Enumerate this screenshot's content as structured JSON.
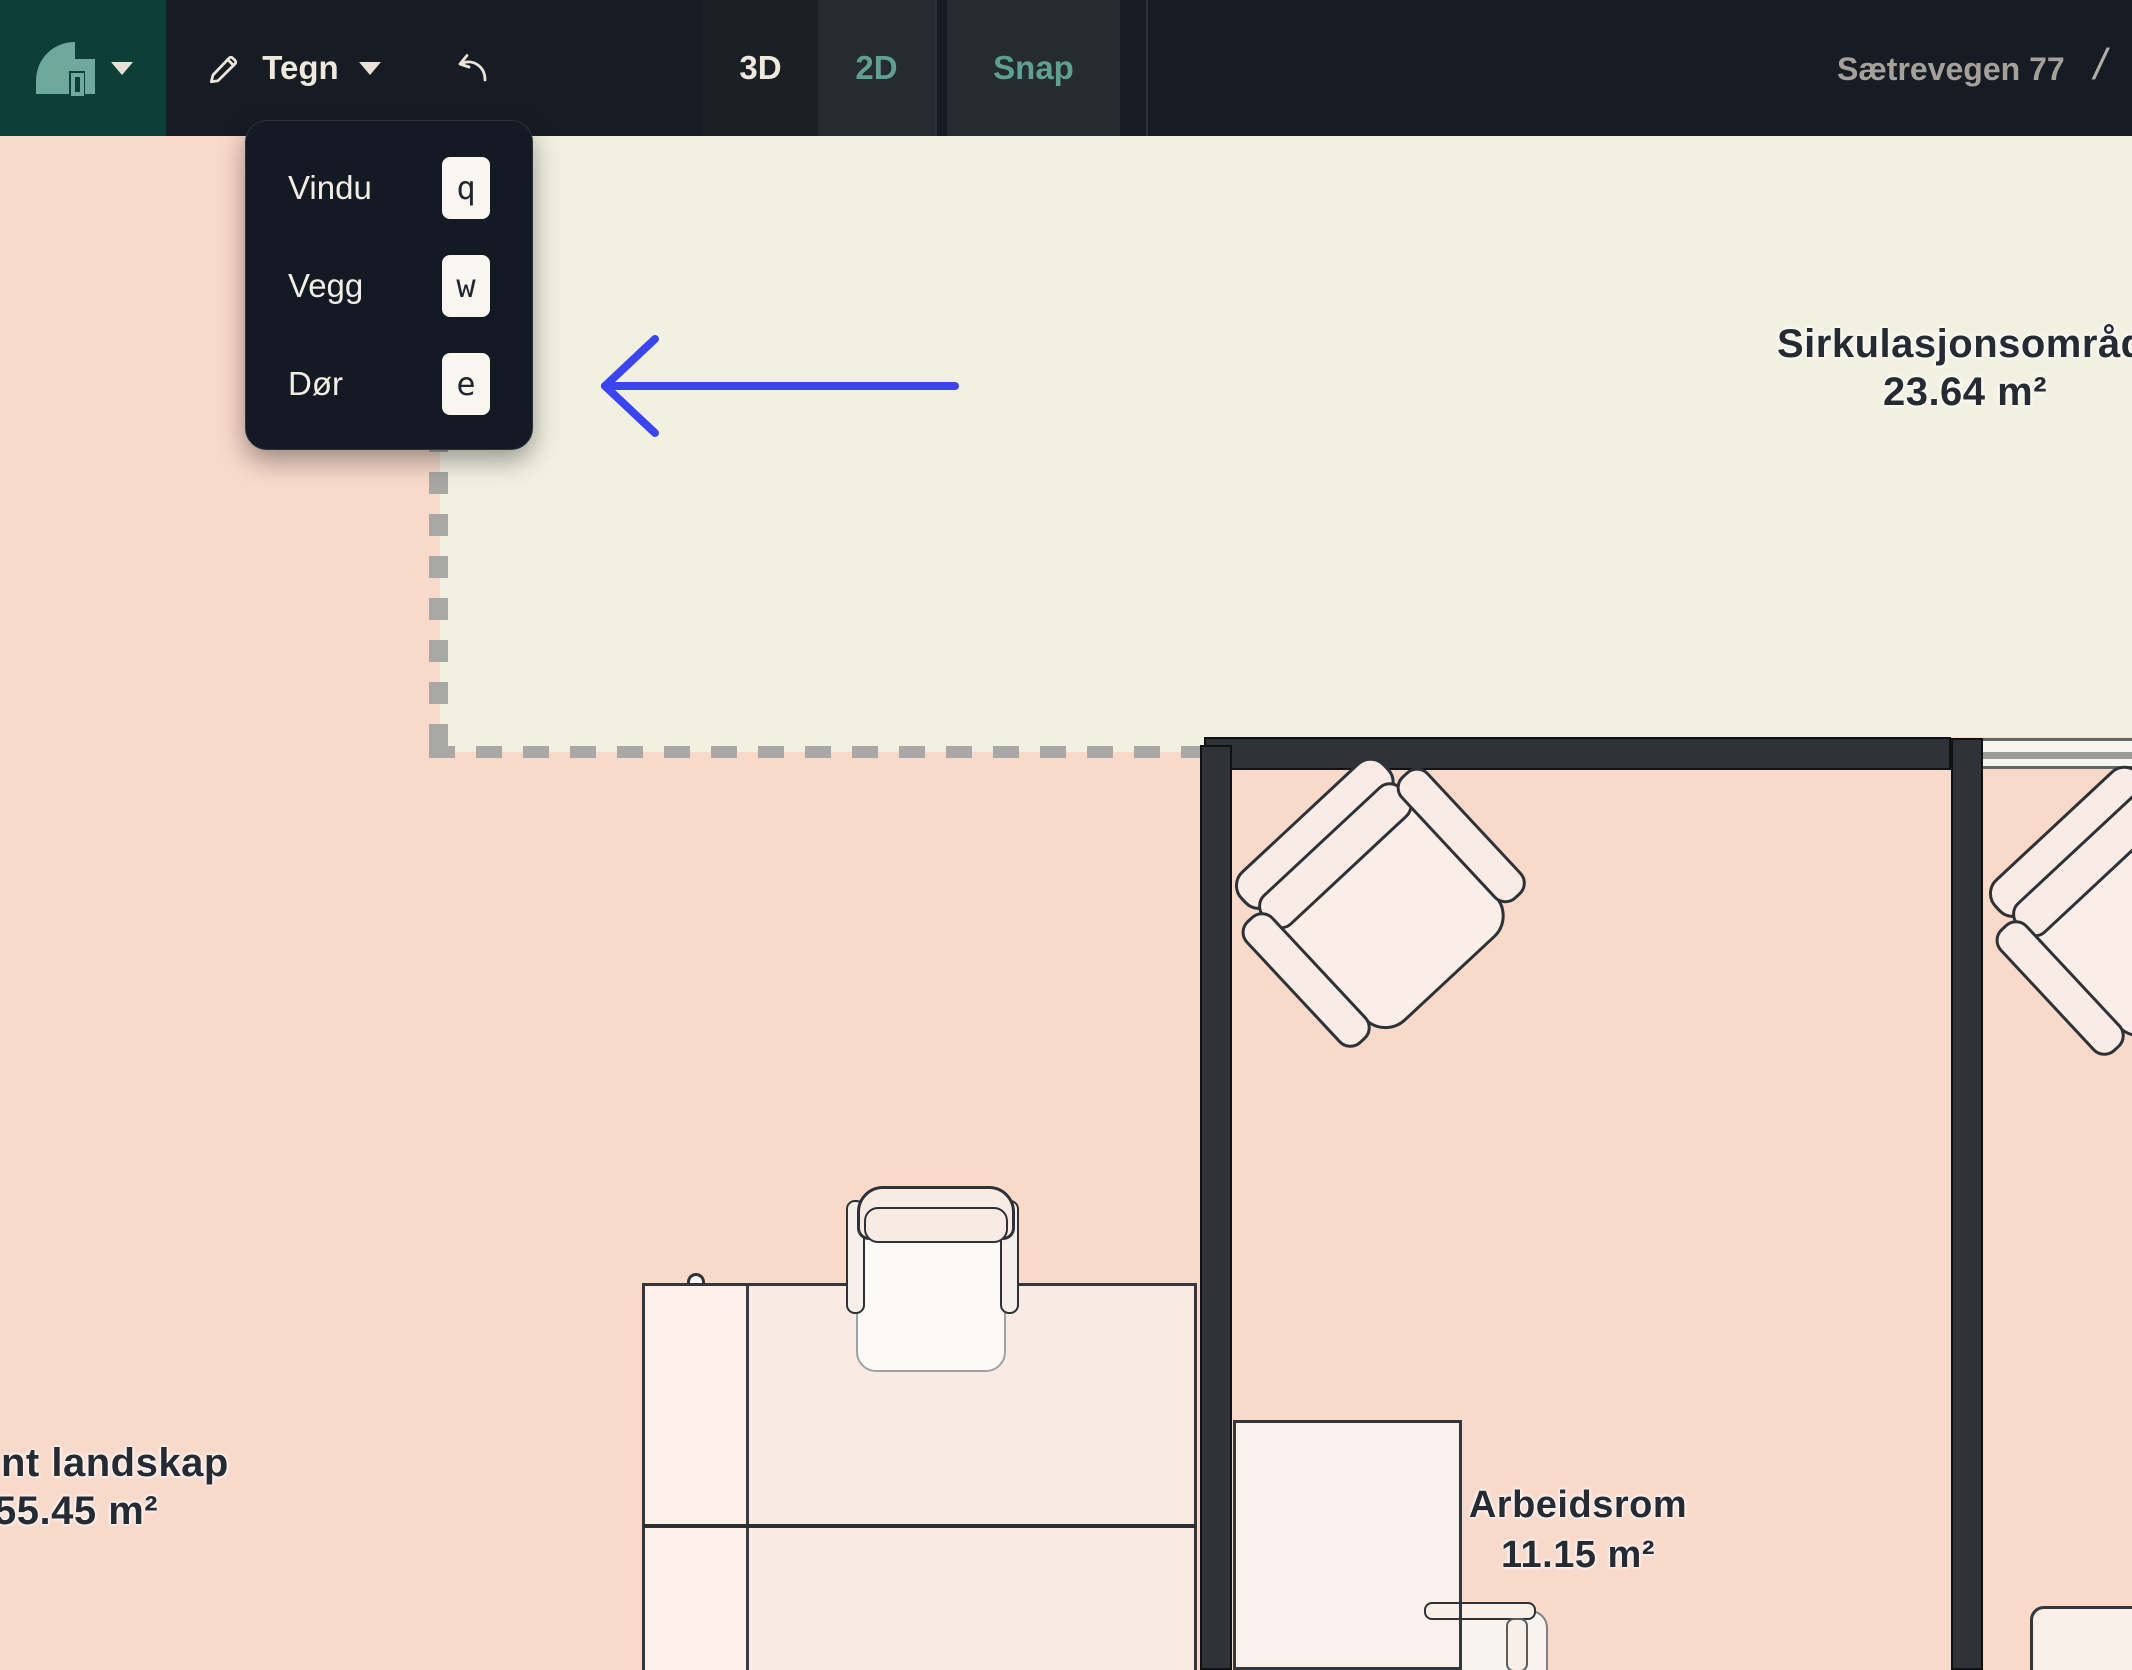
{
  "toolbar": {
    "logo_icon": "roof-logo-icon",
    "draw_tool_label": "Tegn",
    "view_3d_label": "3D",
    "view_2d_label": "2D",
    "snap_label": "Snap",
    "project_name": "Sætrevegen 77",
    "breadcrumb_separator": "/"
  },
  "draw_menu": {
    "items": [
      {
        "label": "Vindu",
        "key": "q"
      },
      {
        "label": "Vegg",
        "key": "w"
      },
      {
        "label": "Dør",
        "key": "e"
      }
    ]
  },
  "floorplan": {
    "rooms": [
      {
        "name": "Sirkulasjonsområde",
        "area": "23.64 m²"
      },
      {
        "name": "nt landskap",
        "area": "55.45 m²"
      },
      {
        "name": "Arbeidsrom",
        "area": "11.15 m²"
      }
    ],
    "furniture": [
      "armchair",
      "office-chair",
      "desk",
      "window"
    ],
    "annotation": "blue-arrow-pointing-left-at-draw-menu"
  },
  "colors": {
    "floor_pink": "#f8d9ca",
    "room_cream": "#f2f1e1",
    "wall": "#2f3337",
    "toolbar_bg": "#171c24",
    "logo_tile": "#0e3e38",
    "accent_teal": "#5fa093",
    "arrow_blue": "#3b45ef",
    "dash_gray": "#a8a8a6"
  }
}
